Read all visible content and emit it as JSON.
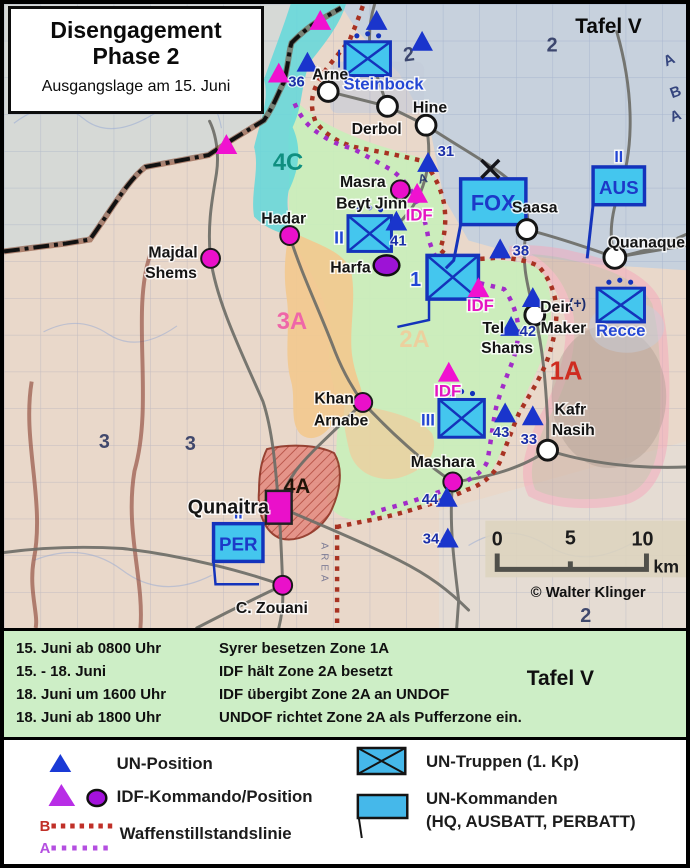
{
  "title_box": {
    "line1": "Disengagement",
    "line2": "Phase 2",
    "subtitle": "Ausgangslage am 15. Juni"
  },
  "map": {
    "tafel_label": "Tafel V",
    "copyright": "© Walter Klinger",
    "scalebar": {
      "t0": "0",
      "t5": "5",
      "t10": "10",
      "unit": "km"
    },
    "zones": {
      "z4c": "4C",
      "z3a": "3A",
      "z2a": "2A",
      "z1a": "1A",
      "z4a": "4A"
    },
    "places": {
      "arne": "Arne",
      "derbol": "Derbol",
      "hine": "Hine",
      "saasa": "Saasa",
      "quanaque": "Quanaque",
      "deir1": "Deir",
      "deir2": "Maker",
      "tel1": "Tel",
      "tel2": "Shams",
      "kafr1": "Kafr",
      "kafr2": "Nasih",
      "masra1": "Masra",
      "masra2": "Beyt Jinn",
      "hadar": "Hadar",
      "majdal1": "Majdal",
      "majdal2": "Shems",
      "harfa": "Harfa",
      "khan1": "Khan",
      "khan2": "Arnabe",
      "mashara": "Mashara",
      "qunaitra": "Qunaitra",
      "zouani": "C. Zouani"
    },
    "un_numbers": {
      "n36": "36",
      "n31": "31",
      "n41": "41",
      "n38": "38",
      "n42": "42",
      "n43": "43",
      "n33": "33",
      "n44": "44",
      "n34": "34"
    },
    "idf_label": "IDF",
    "units": {
      "steinbock": "Steinbock",
      "recce": "Recce",
      "recce_mod": "(+)",
      "fox": "FOX",
      "aus": "AUS",
      "per": "PER",
      "ech_ii": "II",
      "ech_iii": "III",
      "box1": "1"
    },
    "basemap": {
      "g2a": "2",
      "g2b": "2",
      "g2c": "2",
      "g3a": "3",
      "g3b": "3",
      "a1": "A",
      "b1": "B",
      "a2": "A",
      "a3": "A",
      "area": "AREA"
    }
  },
  "timeline": {
    "rows": [
      {
        "time": "15. Juni ab 0800 Uhr",
        "event": "Syrer besetzen Zone 1A"
      },
      {
        "time": "15.  - 18. Juni",
        "event": "IDF hält Zone 2A besetzt"
      },
      {
        "time": "18. Juni um 1600 Uhr",
        "event": "IDF übergibt Zone 2A an UNDOF"
      },
      {
        "time": "18. Juni ab 1800 Uhr",
        "event": "UNDOF richtet Zone 2A als Pufferzone ein."
      }
    ],
    "tafel_label": "Tafel V"
  },
  "legend": {
    "un_position": "UN-Position",
    "idf_position": "IDF-Kommando/Position",
    "line_b": "B",
    "line_a": "A",
    "ceasefire": "Waffenstillstandslinie",
    "un_troops": "UN-Truppen (1. Kp)",
    "un_hq_line1": "UN-Kommanden",
    "un_hq_line2": "(HQ, AUSBATT, PERBATT)"
  },
  "colors": {
    "un_blue": "#1a35cc",
    "unit_cyan": "#44c6ee",
    "unit_navy": "#1433bb",
    "idf_magenta": "#ee10cc",
    "idf_purple": "#9d13d6",
    "zone_cyan": "#62d8da",
    "zone_green": "#c9efba",
    "zone_orange": "#f2c98f",
    "zone_red_1a": "#d03024",
    "zone_pink_band": "#f5a8bc",
    "line_b_red": "#a83222",
    "line_a_purple": "#a22cc8",
    "panel_green": "#cdeec6"
  }
}
